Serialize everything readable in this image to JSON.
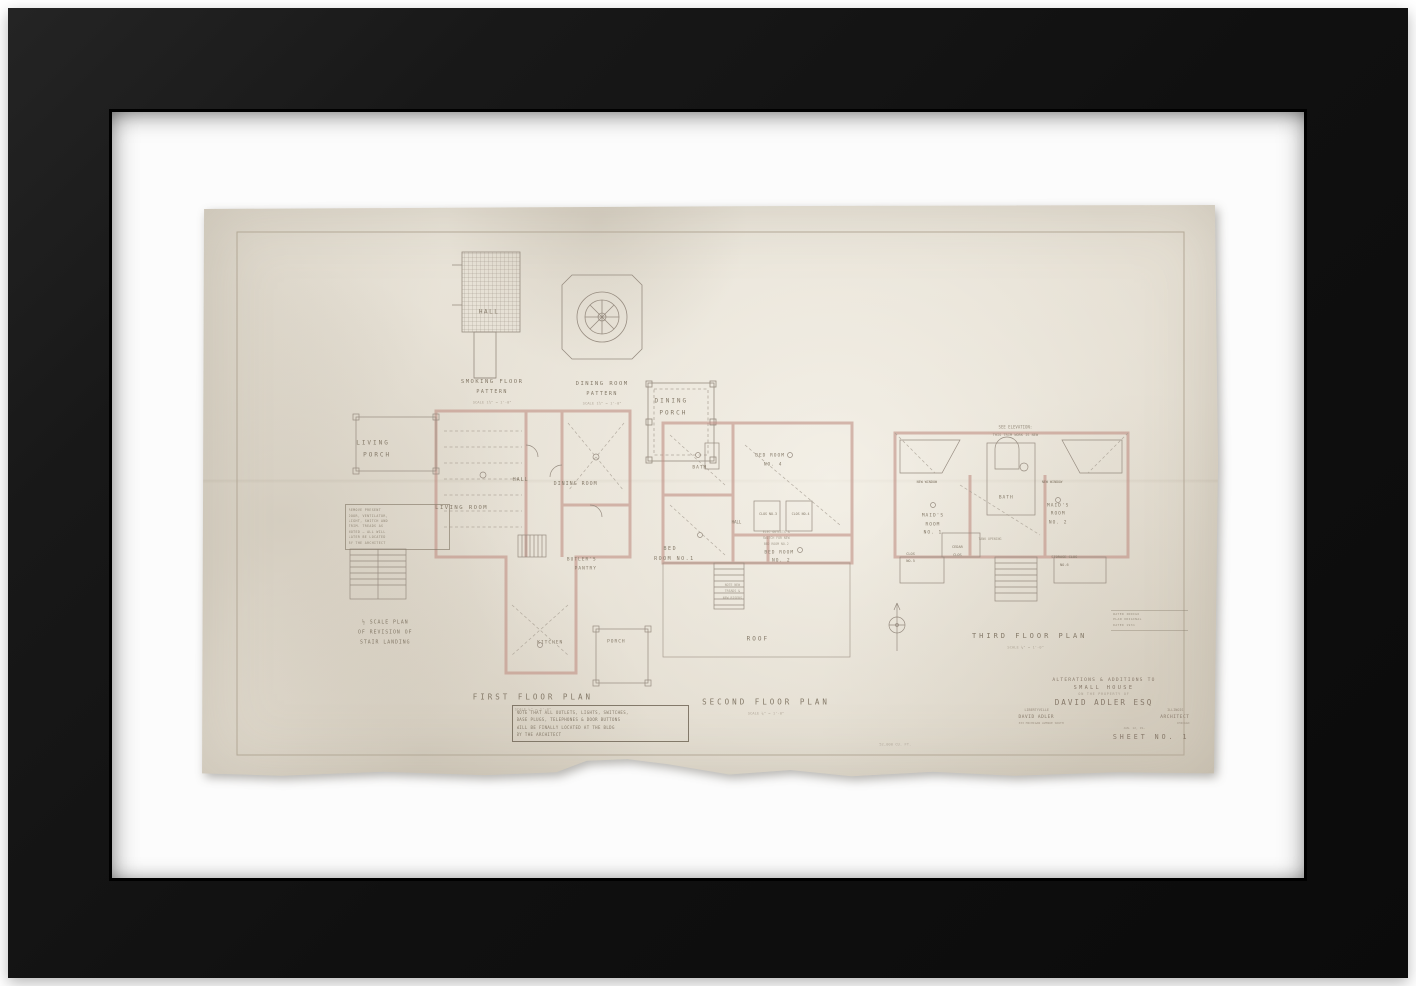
{
  "colors": {
    "frame": "#141414",
    "mat": "#fcfcfc",
    "paper": "#e6e0d4",
    "wall_poche": "#c09084",
    "pencil": "#978c80"
  },
  "sheet": {
    "labels": [
      {
        "t": "HALL",
        "x": 28.4,
        "y": 18.6,
        "fs": 6,
        "ls": 1.5,
        "n": "hall-pattern-label"
      },
      {
        "t": "SMOKING FLOOR",
        "x": 28.7,
        "y": 30.9,
        "fs": 5.5,
        "ls": 1.5,
        "n": "smoking-floor-pattern-title"
      },
      {
        "t": "PATTERN",
        "x": 28.7,
        "y": 32.7,
        "fs": 5,
        "ls": 1.5
      },
      {
        "t": "SCALE 1½\" = 1'-0\"",
        "x": 28.7,
        "y": 34.3,
        "fs": 3.8,
        "o": 0.55
      },
      {
        "t": "DINING ROOM",
        "x": 39.5,
        "y": 31.2,
        "fs": 5.5,
        "ls": 1.5,
        "n": "dining-room-pattern-title"
      },
      {
        "t": "PATTERN",
        "x": 39.5,
        "y": 33.0,
        "fs": 5,
        "ls": 1.5
      },
      {
        "t": "SCALE 1½\" = 1'-0\"",
        "x": 39.5,
        "y": 34.6,
        "fs": 3.8,
        "o": 0.55
      },
      {
        "t": "DINING",
        "x": 46.3,
        "y": 34.2,
        "fs": 6,
        "ls": 2,
        "n": "dining-porch-label"
      },
      {
        "t": "PORCH",
        "x": 46.5,
        "y": 36.3,
        "fs": 6,
        "ls": 2
      },
      {
        "t": "LIVING",
        "x": 17.0,
        "y": 41.5,
        "fs": 6,
        "ls": 2,
        "n": "living-porch-label"
      },
      {
        "t": "PORCH",
        "x": 17.4,
        "y": 43.6,
        "fs": 6,
        "ls": 2
      },
      {
        "t": "LIVING ROOM",
        "x": 25.7,
        "y": 52.9,
        "fs": 5.5,
        "ls": 1.5,
        "n": "living-room-label"
      },
      {
        "t": "HALL",
        "x": 31.5,
        "y": 48.0,
        "fs": 5,
        "ls": 1
      },
      {
        "t": "DINING ROOM",
        "x": 36.9,
        "y": 48.7,
        "fs": 5,
        "ls": 1,
        "n": "dining-room-label"
      },
      {
        "t": "BUTLER'S",
        "x": 37.5,
        "y": 62.0,
        "fs": 4.5,
        "ls": 1,
        "n": "butlers-pantry-label"
      },
      {
        "t": "PANTRY",
        "x": 37.9,
        "y": 63.6,
        "fs": 4.5,
        "ls": 1
      },
      {
        "t": "KITCHEN",
        "x": 34.4,
        "y": 76.4,
        "fs": 4.5,
        "ls": 1,
        "n": "kitchen-label"
      },
      {
        "t": "PORCH",
        "x": 40.9,
        "y": 76.3,
        "fs": 4.5,
        "ls": 1
      },
      {
        "t": "½ SCALE PLAN",
        "x": 18.2,
        "y": 73.0,
        "fs": 4.8,
        "ls": 1,
        "n": "stair-landing-caption"
      },
      {
        "t": "OF REVISION OF",
        "x": 18.2,
        "y": 74.7,
        "fs": 4.8,
        "ls": 1
      },
      {
        "t": "STAIR LANDING",
        "x": 18.2,
        "y": 76.4,
        "fs": 4.8,
        "ls": 1
      },
      {
        "t": "FIRST FLOOR PLAN",
        "x": 32.7,
        "y": 85.9,
        "fs": 7.5,
        "ls": 3,
        "n": "first-floor-plan-title"
      },
      {
        "t": "SCALE ¼\" = 1'-0\"",
        "x": 32.7,
        "y": 87.9,
        "fs": 3.8,
        "o": 0.5
      },
      {
        "t": "BATH",
        "x": 49.1,
        "y": 45.9,
        "fs": 4.5,
        "ls": 1
      },
      {
        "t": "BED ROOM",
        "x": 56.0,
        "y": 43.8,
        "fs": 4.5,
        "ls": 1,
        "n": "bed-room-4-label"
      },
      {
        "t": "NO. 4",
        "x": 56.3,
        "y": 45.4,
        "fs": 4.5,
        "ls": 1
      },
      {
        "t": "CLOS NO.3",
        "x": 55.8,
        "y": 54.0,
        "fs": 3.3
      },
      {
        "t": "CLOS NO.4",
        "x": 59.0,
        "y": 54.0,
        "fs": 3.3
      },
      {
        "t": "HALL",
        "x": 52.7,
        "y": 55.3,
        "fs": 4
      },
      {
        "t": "BED",
        "x": 46.2,
        "y": 60.0,
        "fs": 5,
        "ls": 1.5,
        "n": "bed-room-1-label"
      },
      {
        "t": "ROOM NO.1",
        "x": 46.6,
        "y": 61.8,
        "fs": 5,
        "ls": 1.5
      },
      {
        "t": "ELEC OUTLETS &",
        "x": 56.6,
        "y": 57.0,
        "fs": 3.2,
        "o": 0.65
      },
      {
        "t": "SWITCH FOR NEW",
        "x": 56.6,
        "y": 58.1,
        "fs": 3.2,
        "o": 0.65
      },
      {
        "t": "BED ROOM NO.2",
        "x": 56.6,
        "y": 59.2,
        "fs": 3.2,
        "o": 0.65
      },
      {
        "t": "BED ROOM",
        "x": 56.9,
        "y": 60.7,
        "fs": 4.5,
        "ls": 1,
        "n": "bed-room-2-label"
      },
      {
        "t": "NO. 2",
        "x": 57.1,
        "y": 62.2,
        "fs": 4.5,
        "ls": 1
      },
      {
        "t": "NOTE NEW",
        "x": 52.3,
        "y": 66.3,
        "fs": 3.2,
        "o": 0.65
      },
      {
        "t": "TREADS &",
        "x": 52.3,
        "y": 67.4,
        "fs": 3.2,
        "o": 0.65
      },
      {
        "t": "NEW RISERS",
        "x": 52.3,
        "y": 68.5,
        "fs": 3.2,
        "o": 0.65
      },
      {
        "t": "ROOF",
        "x": 54.8,
        "y": 75.7,
        "fs": 6,
        "ls": 2,
        "n": "roof-label"
      },
      {
        "t": "SECOND FLOOR PLAN",
        "x": 55.6,
        "y": 86.7,
        "fs": 7.5,
        "ls": 3,
        "n": "second-floor-plan-title"
      },
      {
        "t": "SCALE ¼\" = 1'-0\"",
        "x": 55.6,
        "y": 88.7,
        "fs": 3.8,
        "o": 0.5
      },
      {
        "t": "SEE ELEVATION:",
        "x": 80.1,
        "y": 38.7,
        "fs": 4,
        "o": 0.8
      },
      {
        "t": "THIS TRIM WORK IS NEW",
        "x": 80.1,
        "y": 40.1,
        "fs": 3.6,
        "o": 0.8
      },
      {
        "t": "NEW WINDOW",
        "x": 71.4,
        "y": 48.3,
        "fs": 3.4
      },
      {
        "t": "NEW WINDOW",
        "x": 83.7,
        "y": 48.3,
        "fs": 3.4
      },
      {
        "t": "BATH",
        "x": 79.2,
        "y": 51.1,
        "fs": 4.5,
        "ls": 1
      },
      {
        "t": "MAID'S",
        "x": 72.0,
        "y": 54.3,
        "fs": 4.5,
        "ls": 1,
        "n": "maids-room-1-label"
      },
      {
        "t": "ROOM",
        "x": 72.0,
        "y": 55.8,
        "fs": 4.5,
        "ls": 1
      },
      {
        "t": "NO. 1",
        "x": 72.0,
        "y": 57.3,
        "fs": 4.5,
        "ls": 1
      },
      {
        "t": "MAID'S",
        "x": 84.3,
        "y": 52.5,
        "fs": 4.5,
        "ls": 1,
        "n": "maids-room-2-label"
      },
      {
        "t": "ROOM",
        "x": 84.3,
        "y": 54.0,
        "fs": 4.5,
        "ls": 1
      },
      {
        "t": "NO. 2",
        "x": 84.3,
        "y": 55.5,
        "fs": 4.5,
        "ls": 1
      },
      {
        "t": "CEDAR",
        "x": 74.4,
        "y": 59.7,
        "fs": 3.6
      },
      {
        "t": "CLOS",
        "x": 74.4,
        "y": 61.0,
        "fs": 3.6
      },
      {
        "t": "CLOS",
        "x": 69.8,
        "y": 60.9,
        "fs": 3.6
      },
      {
        "t": "NO.5",
        "x": 69.8,
        "y": 62.2,
        "fs": 3.6
      },
      {
        "t": "STORAGE CLOS",
        "x": 84.9,
        "y": 61.5,
        "fs": 3.6
      },
      {
        "t": "NO.6",
        "x": 84.9,
        "y": 62.8,
        "fs": 3.6
      },
      {
        "t": "TANK OPENING",
        "x": 77.6,
        "y": 58.3,
        "fs": 3.2,
        "o": 0.7
      },
      {
        "t": "THIRD FLOOR PLAN",
        "x": 81.5,
        "y": 75.2,
        "fs": 7,
        "ls": 3,
        "n": "third-floor-plan-title"
      },
      {
        "t": "SCALE ¼\" = 1'-0\"",
        "x": 81.1,
        "y": 77.1,
        "fs": 3.8,
        "o": 0.5
      },
      {
        "t": "52,000 CU. FT.",
        "x": 68.3,
        "y": 94.0,
        "fs": 3.8,
        "o": 0.45,
        "n": "volume-note"
      }
    ],
    "service_note": {
      "lines": [
        "REMOVE PRESENT",
        "DOOR, VENTILATOR,",
        "LIGHT, SWITCH AND",
        "TRIM. TREADS AS",
        "NOTED — ALL WILL",
        "LATER BE LOCATED",
        "BY THE ARCHITECT"
      ]
    },
    "note_box": {
      "lines": [
        "NOTE THAT ALL OUTLETS, LIGHTS, SWITCHES,",
        "BASE PLUGS, TELEPHONES & DOOR BUTTONS",
        "WILL BE FINALLY LOCATED AT THE BLDG",
        "BY THE ARCHITECT"
      ]
    },
    "stamp": {
      "lines": [
        "WATER INDIGO",
        "PLAN ORIGINAL",
        "DATED 1931"
      ]
    },
    "title_block": {
      "line1": "ALTERATIONS & ADDITIONS TO",
      "line2": "SMALL HOUSE",
      "line3": "ON THE PROPERTY OF",
      "owner": "DAVID ADLER ESQ",
      "city": "LIBERTYVILLE",
      "state": "ILLINOIS",
      "architect": "DAVID ADLER",
      "role": "ARCHITECT",
      "address": "333 MICHIGAN AVENUE SOUTH",
      "address_city": "CHICAGO",
      "date": "JAN. 12, 19—",
      "sheet": "SHEET NO. 1"
    }
  }
}
